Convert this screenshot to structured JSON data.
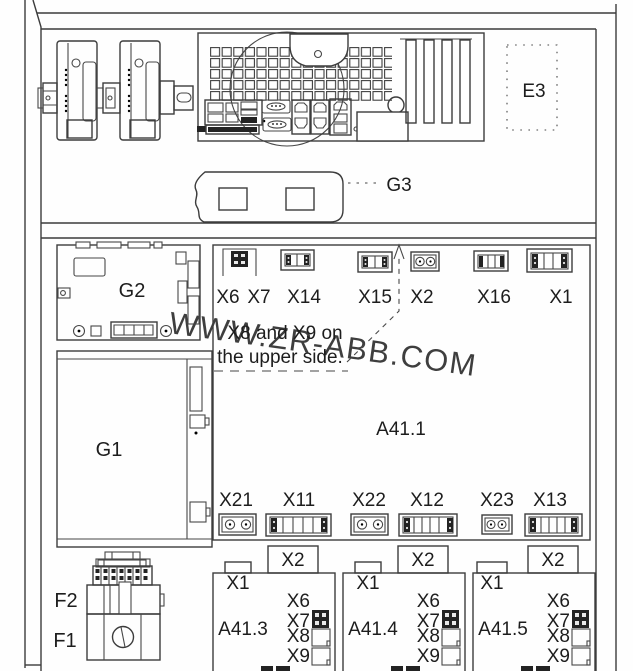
{
  "page": {
    "background": "#fefefe",
    "line_color": "#3c3c3c",
    "text_color": "#1d1d1d",
    "watermark_color": "#bfbfbf"
  },
  "watermark": "WWW.ZR-ABB.COM",
  "top_section": {
    "e3_label": "E3",
    "g3_label": "G3"
  },
  "mid_section": {
    "g2_label": "G2",
    "g1_label": "G1",
    "a41_1": {
      "label": "A41.1",
      "note_line1": "X8 and X9 on",
      "note_line2": "the upper side.",
      "top_connectors": {
        "x6": "X6",
        "x7": "X7",
        "x14": "X14",
        "x15": "X15",
        "x2": "X2",
        "x16": "X16",
        "x1": "X1"
      },
      "bottom_connectors": {
        "x21": "X21",
        "x11": "X11",
        "x22": "X22",
        "x12": "X12",
        "x23": "X23",
        "x13": "X13"
      }
    }
  },
  "bottom_section": {
    "f2_label": "F2",
    "f1_label": "F1",
    "drive_units": [
      {
        "label": "A41.3",
        "x2": "X2",
        "x1": "X1",
        "x6": "X6",
        "x7": "X7",
        "x8": "X8",
        "x9": "X9"
      },
      {
        "label": "A41.4",
        "x2": "X2",
        "x1": "X1",
        "x6": "X6",
        "x7": "X7",
        "x8": "X8",
        "x9": "X9"
      },
      {
        "label": "A41.5",
        "x2": "X2",
        "x1": "X1",
        "x6": "X6",
        "x7": "X7",
        "x8": "X8",
        "x9": "X9"
      }
    ]
  }
}
